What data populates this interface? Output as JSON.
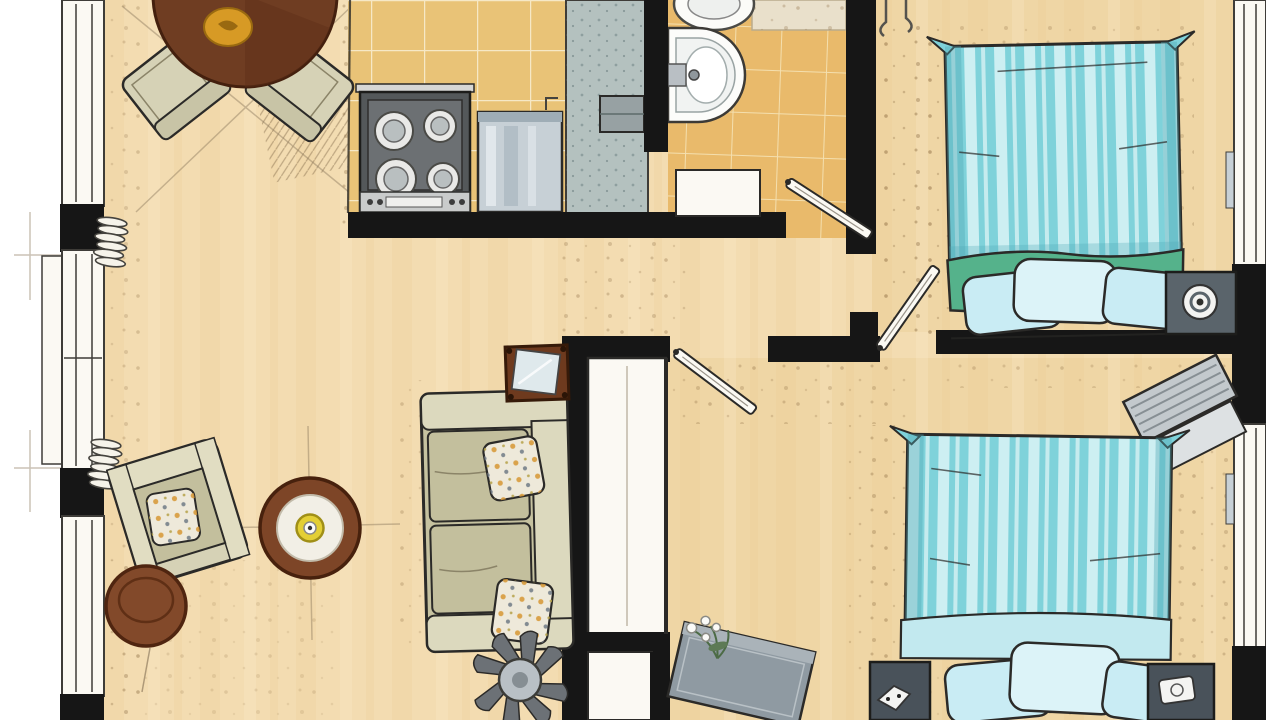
{
  "meta": {
    "kind": "hand-drawn-floor-plan",
    "view": "top-down",
    "style": "watercolor-marker-sketch",
    "width_px": 1280,
    "height_px": 720,
    "visible_text": ""
  },
  "palette": {
    "paper": "#ffffff",
    "paper_warm": "#fbf9f3",
    "wall": "#161616",
    "line": "#2b2a28",
    "window_line": "#3e3c38",
    "floor": "#f3dcb1",
    "floor_deep": "#eccf97",
    "wood_streak1": "#e8c78c",
    "wood_streak2": "#fbeccb",
    "kitchen_tile": "#e9c377",
    "kitchen_grout": "#f6e8c6",
    "bath_tile": "#e9ba6b",
    "bath_grout": "#f4dfae",
    "counter": "#b4c1bf",
    "counter_dot": "#74898a",
    "stove": "#54585a",
    "metal": "#c7d0d6",
    "duvet": "#7fd2da",
    "duvet_stripe": "#cdeff2",
    "duvet_shade": "#4fa8b5",
    "blanket": "#55b28b",
    "pillow": "#c9ecf4",
    "pillow_light": "#dcf3f8",
    "sofa": "#c6c2a0",
    "sofa_light": "#dcd9be",
    "chair": "#d6d2b6",
    "cushion": "#c3bf9d",
    "pillow_cream": "#eee9da",
    "dot_orange": "#d89b3c",
    "dot_slate": "#76808a",
    "wood_dark": "#6f3d22",
    "wood_mid": "#82492a",
    "wood_ring": "#7d4527",
    "gold": "#d79a25",
    "night1": "#5a646b",
    "night2": "#49525a",
    "desk": "#c3c9cd",
    "bench": "#8f9aa2",
    "plant_leaf": "#6c7176",
    "plant_green": "#4c6b45",
    "accent_yellow": "#e3cf35",
    "speck": "#8a6a40",
    "hatch": "#6a5134"
  },
  "rooms": [
    {
      "id": "living-dining",
      "furniture": [
        "round-dining-table",
        "dining-chair-left",
        "dining-chair-right",
        "armchair",
        "round-side-table",
        "round-coffee-table",
        "sofa",
        "mirror-cabinet",
        "fan-plant"
      ]
    },
    {
      "id": "kitchen",
      "furniture": [
        "stove-4-burners",
        "steel-counter-unit",
        "countertop-strip",
        "small-appliance"
      ]
    },
    {
      "id": "bathroom",
      "furniture": [
        "pedestal-sink",
        "toilet",
        "bath-mat",
        "door-leaf"
      ]
    },
    {
      "id": "bedroom-1",
      "furniture": [
        "double-bed-striped-duvet",
        "green-blanket",
        "three-pillows",
        "nightstand-with-lamp",
        "wall-hooks",
        "door-leaf"
      ]
    },
    {
      "id": "bedroom-2",
      "furniture": [
        "double-bed-striped-duvet",
        "three-pillows",
        "nightstand-left",
        "nightstand-right",
        "desk",
        "bench-with-flowers",
        "door-leaf"
      ]
    },
    {
      "id": "hallway",
      "furniture": [
        "built-in-closet"
      ]
    }
  ],
  "openings": {
    "left_wall": [
      "window",
      "balcony-window",
      "window"
    ],
    "right_wall": [
      "window-bedroom-1",
      "window-bedroom-2"
    ],
    "doors": [
      "bathroom",
      "bedroom-1",
      "bedroom-2"
    ]
  }
}
